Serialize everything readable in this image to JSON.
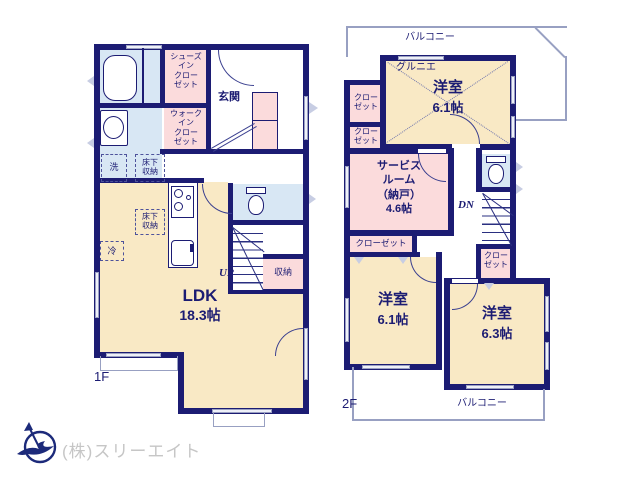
{
  "floor1": {
    "label": "1F",
    "ldk_name": "LDK",
    "ldk_size": "18.3帖",
    "genkan": "玄関",
    "shoes_closet": [
      "シューズ",
      "イン",
      "クロー",
      "ゼット"
    ],
    "walkin_closet": [
      "ウォーク",
      "イン",
      "クロー",
      "ゼット"
    ],
    "laundry": "洗",
    "underfloor_wash": [
      "床下",
      "収納"
    ],
    "underfloor_ldk": [
      "床下",
      "収納"
    ],
    "fridge": "冷",
    "storage": "収納",
    "stairs_up": "UP"
  },
  "floor2": {
    "label": "2F",
    "balcony_top": "バルコニー",
    "balcony_bottom": "バルコニー",
    "grenier": "グルニエ",
    "room_a_name": "洋室",
    "room_a_size": "6.1帖",
    "service_room": [
      "サービス",
      "ルーム",
      "（納戸）",
      "4.6帖"
    ],
    "closet_left_upper": [
      "クロー",
      "ゼット"
    ],
    "closet_left_lower": [
      "クロー",
      "ゼット"
    ],
    "closet_mid": "クローゼット",
    "closet_right": [
      "クロー",
      "ゼット"
    ],
    "room_b_name": "洋室",
    "room_b_size": "6.1帖",
    "room_c_name": "洋室",
    "room_c_size": "6.3帖",
    "stairs_down": "DN"
  },
  "footer": {
    "company": "(株)スリーエイト"
  },
  "colors": {
    "wall": "#1c1c73",
    "room_cream": "#f9e9c5",
    "closet_pink": "#fbdbdc",
    "wet_blue": "#d8e7f4",
    "outline_gray": "#98a0c2",
    "company_gray": "#c6c6c6"
  }
}
